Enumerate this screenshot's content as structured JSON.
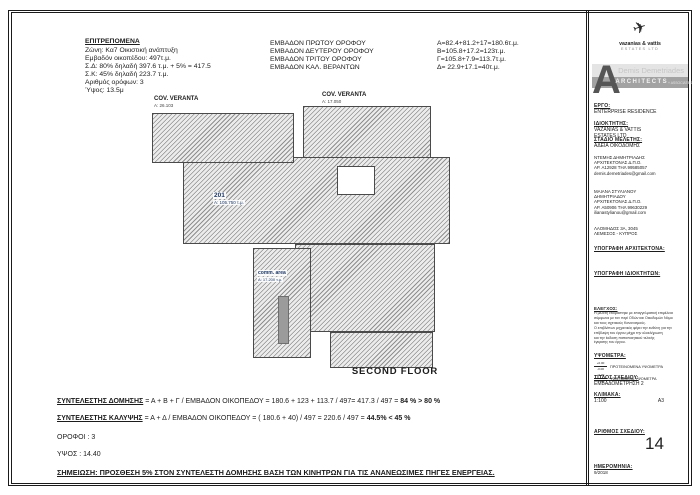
{
  "palette": {
    "line": "#1a1a1a",
    "hatch_gray": "#8f8f8f",
    "label_navy": "#1f3864",
    "band_light": "#e4e4e4",
    "band_dark": "#a2a2a2"
  },
  "permitted": {
    "title": "ΕΠΙΤΡΕΠΟΜΕΝΑ",
    "lines": [
      "Ζώνη: Κα7 Οικιστική ανάπτυξη",
      "Εμβαδόν οικοπέδου: 497τ.μ.",
      "Σ.Δ: 80% δηλαδή 397.6 τ.μ. + 5% = 417.5",
      "Σ.Κ: 45% δηλαδή 223.7 τ.μ.",
      "Αριθμός ορόφων: 3",
      "Ύψος: 13.5μ"
    ]
  },
  "areas": {
    "rows": [
      {
        "label": "ΕΜΒΑΔΟΝ ΠΡΩΤΟΥ ΟΡΟΦΟΥ",
        "value": "Α=82.4+81.2+17=180.6τ.μ."
      },
      {
        "label": "ΕΜΒΑΔΟΝ ΔΕΥΤΕΡΟΥ ΟΡΟΦΟΥ",
        "value": "Β=105.8+17.2=123τ.μ."
      },
      {
        "label": "ΕΜΒΑΔΟΝ ΤΡΙΤΟΥ ΟΡΟΦΟΥ",
        "value": "Γ=105.8+7.9=113.7τ.μ."
      },
      {
        "label": "ΕΜΒΑΔΟΝ ΚΑΛ. ΒΕΡΑΝΤΩΝ",
        "value": "Δ= 22.9+17.1=40τ.μ."
      }
    ]
  },
  "plan": {
    "veranta1": {
      "name": "COV. VERANTA",
      "area": "A: 26.103"
    },
    "veranta2": {
      "name": "COV. VERANTA",
      "area": "A: 17.050"
    },
    "unit": {
      "name": "201",
      "area": "A: 105.750 τ.μ."
    },
    "common": {
      "name": "comm. area",
      "area": "A: 17.200 τ.μ."
    },
    "floor_caption": "SECOND FLOOR"
  },
  "calc": {
    "dom_head": "ΣΥΝΤΕΛΕΣΤΗΣ ΔΟΜΗΣΗΣ",
    "dom_body": " = Α + Β + Γ / ΕΜΒΑΔΟΝ ΟΙΚΟΠΕΔΟΥ = 180.6 + 123 + 113.7 / 497= 417.3 / 497 = ",
    "dom_result": "84 % > 80 %",
    "kal_head": "ΣΥΝΤΕΛΕΣΤΗΣ ΚΑΛΥΨΗΣ",
    "kal_body": " = Α + Δ / ΕΜΒΑΔΟΝ ΟΙΚΟΠΕΔΟΥ = ( 180.6 + 40) / 497 = 220.6 / 497 = ",
    "kal_result": "44.5% < 45 %",
    "floors": "ΟΡΟΦΟΙ : 3",
    "height": "ΥΨΟΣ : 14.40",
    "note": "ΣΗΜΕΙΩΣΗ: ΠΡΟΣΘΕΣΗ 5% ΣΤΟΝ ΣΥΝΤΕΛΕΣΤΗ ΔΟΜΗΣΗΣ ΒΑΣΗ ΤΩΝ ΚΙΝΗΤΡΩΝ ΓΙΑ ΤΙΣ ΑΝΑΝΕΩΣΙΜΕΣ ΠΗΓΕΣ ΕΝΕΡΓΕΙΑΣ."
  },
  "titleblock": {
    "company": {
      "name": "vazanias & vattis",
      "sub": "ESTATES LTD",
      "plane_icon": "✈"
    },
    "band": {
      "letter": "A",
      "name": "Demis Demetriades",
      "word": "ARCHITECTS",
      "assoc": "+ ASSOCIATES"
    },
    "project": {
      "label": "ΕΡΓΟ:",
      "value": "ENTERPRISE RESIDENCE"
    },
    "owner": {
      "label": "ΙΔΙΟΚΤΗΤΗΣ:",
      "line1": "VAZANIAS & VATTIS",
      "line2": "ESTATES LTD"
    },
    "stage": {
      "label": "ΣΤΑΔΙΟ ΜΕΛΕΤΗΣ:",
      "value": "ΑΔΕΙΑ ΟΙΚΟΔΟΜΗΣ"
    },
    "architect1": {
      "lines": [
        "ΝΤΕΜΗΣ ΔΗΜΗΤΡΙΑΔΗΣ",
        "ΑΡΧΙΤΕΚΤΟΝΑΣ Δ.Π.Ο.",
        "ΑΡ. Α12928 ΤΗΛ 99585057",
        "demis.demetriades@gmail.com"
      ]
    },
    "architect2": {
      "lines": [
        "ΜΑΙΑΝΑ ΣΤΥΛΙΑΝΟΥ",
        "ΔΗΜΗΤΡΙΑΔΟΥ",
        "ΑΡΧΙΤΕΚΤΟΝΑΣ Δ.Π.Ο.",
        "ΑΡ. Α50906 ΤΗΛ 99630229",
        "ilianastylianou@gmail.com"
      ]
    },
    "address": {
      "line1": "ΛΑΟΜΗΔΟΣ 3Α, 3045",
      "line2": "ΛΕΜΕΣΟΣ - ΚΥΠΡΟΣ"
    },
    "sign_architect": "ΥΠΟΓΡΑΦΗ ΑΡΧΙΤΕΚΤΟΝΑ:",
    "sign_owner": "ΥΠΟΓΡΑΦΗ ΙΔΙΟΚΤΗΤΩΝ:",
    "check": {
      "label": "ΕΛΕΓΧΟΣ:",
      "lines": [
        "Η μελέτη ετοιμάστηκε με επαγγελματική επιμέλεια",
        "σύμφωνα με τον περί Οδών και Οικοδομών Νόμο",
        "και τους σχετικούς Κανονισμούς.",
        "Ο επιβλέπων μηχανικός φέρει την ευθύνη για την",
        "επίβλεψη του έργου μέχρι την ολοκλήρωση",
        "και την έκδοση πιστοποιητικού τελικής",
        "έγκρισης του έργου."
      ]
    },
    "levels": {
      "label": "ΥΨΟΜΕΤΡΑ:",
      "plus": "+0.00",
      "minus": "-0.00",
      "proposed": "ΠΡΟΤΕΙΝΟΜΕΝΑ ΥΨΟΜΕΤΡΑ",
      "existing": "ΥΦΙΣΤΑΜΕΝΑ ΥΨΟΜΕΤΡΑ"
    },
    "drawing_title": {
      "label": "ΤΙΤΛΟΣ ΣΧΕΔΙΟΥ:",
      "value": "ΕΜΒΑΔΟΜΕΤΡΗΣΗ 2"
    },
    "scale": {
      "label": "ΚΛΙΜΑΚΑ:",
      "value": "1:100",
      "paper": "A3"
    },
    "number": {
      "label": "ΑΡΙΘΜΟΣ ΣΧΕΔΙΟΥ:",
      "value": "14"
    },
    "date": {
      "label": "ΗΜΕΡΟΜΗΝΙΑ:",
      "value": "9/2018"
    }
  }
}
